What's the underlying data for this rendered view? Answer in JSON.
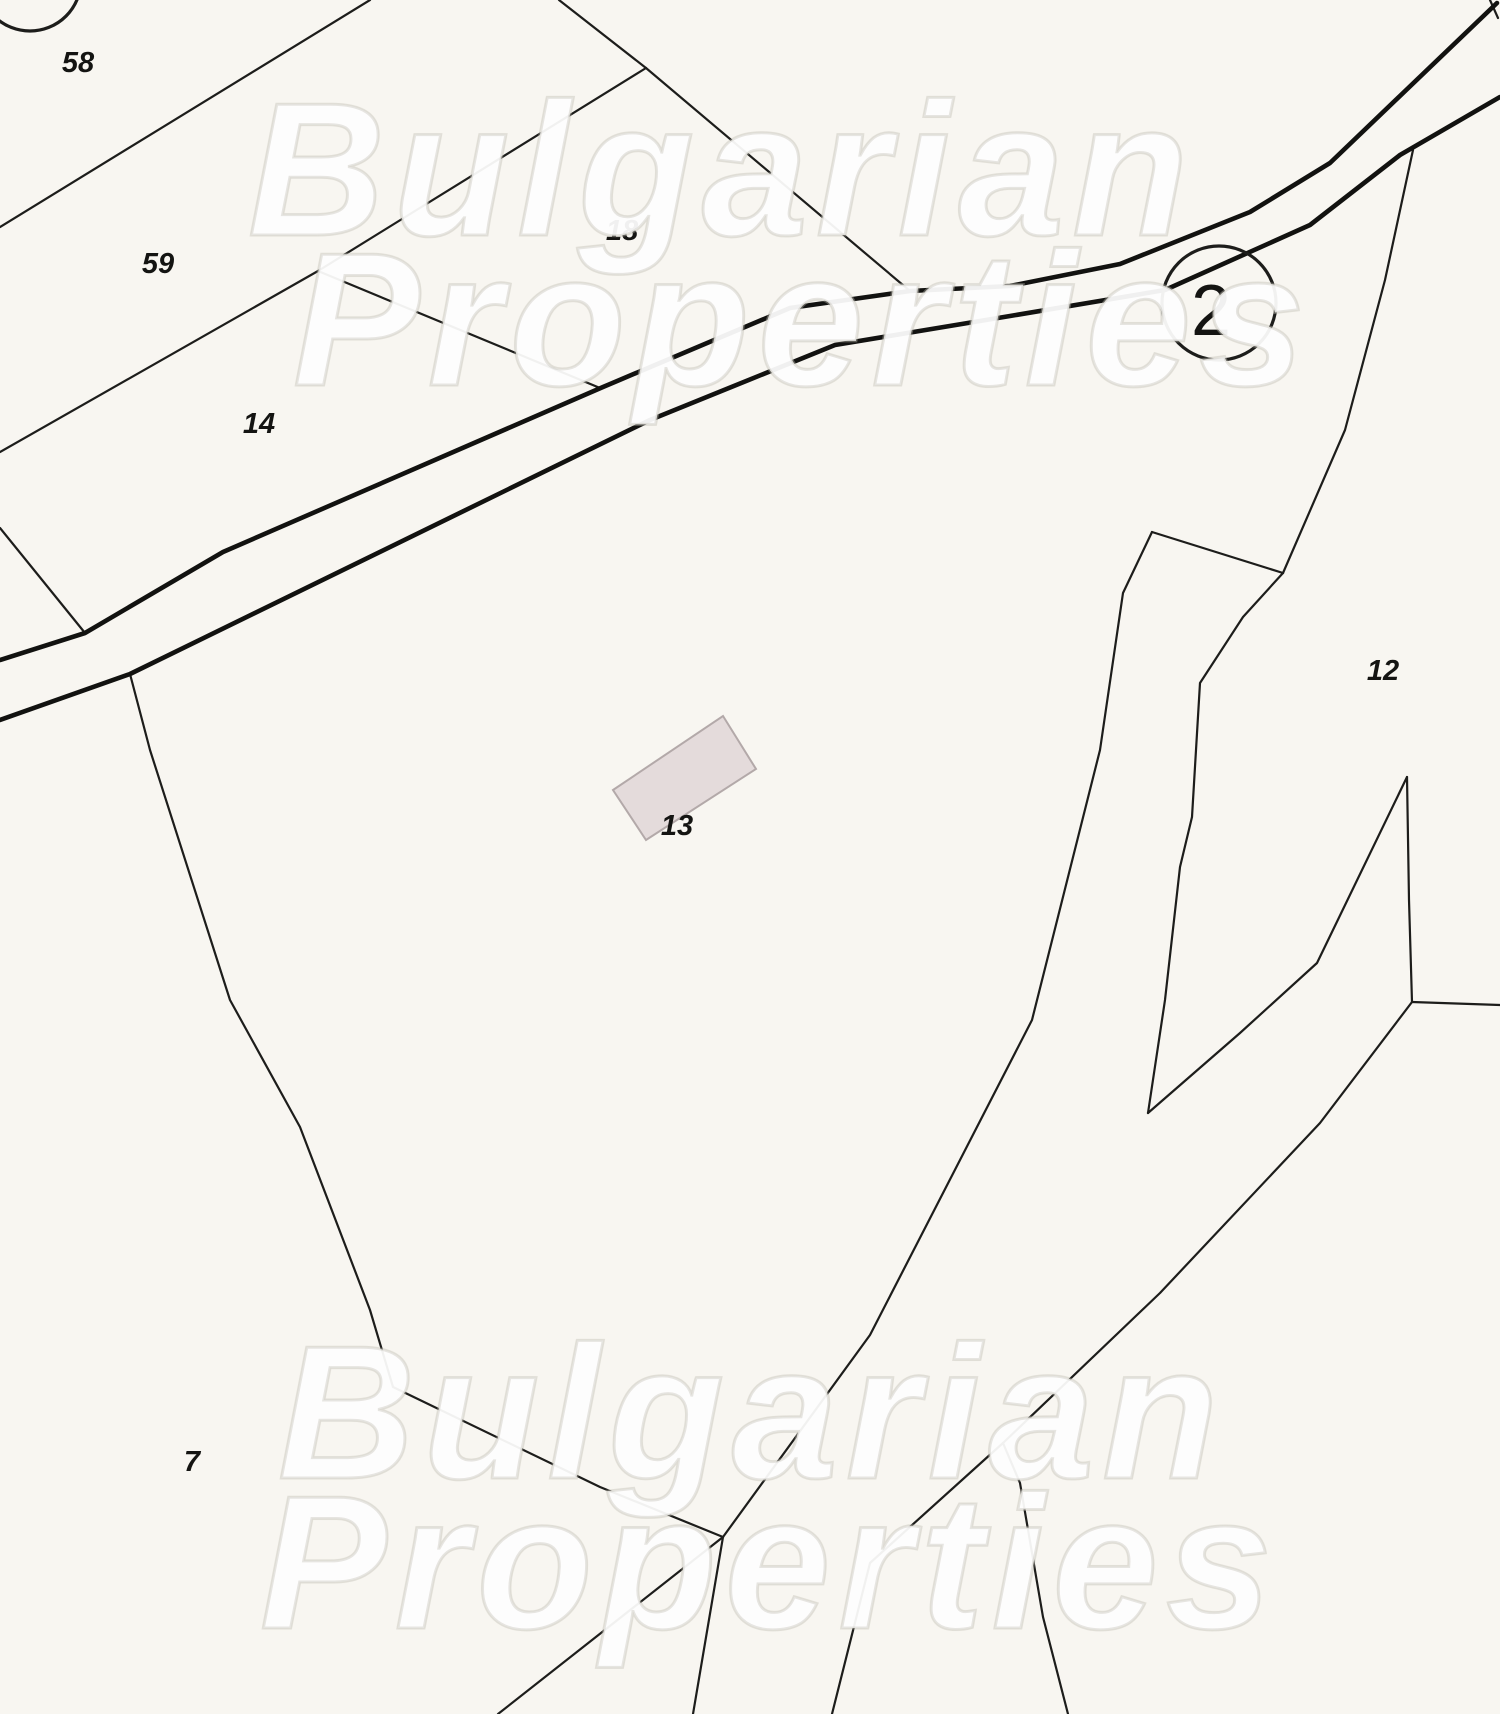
{
  "map": {
    "type": "cadastral-plan",
    "background": "#f8f6f1",
    "colors": {
      "boundary": "#1d1d1b",
      "road": "#121210",
      "label": "#141412",
      "marker": "#1d1d1b",
      "building_fill": "#e4dbdb",
      "building_stroke": "#b3a9a9"
    },
    "watermark": {
      "line1": "Bulgarian",
      "line2": "Properties"
    },
    "parcel_labels": [
      {
        "text": "58",
        "x": 78,
        "y": 63
      },
      {
        "text": "59",
        "x": 158,
        "y": 264
      },
      {
        "text": "14",
        "x": 259,
        "y": 424
      },
      {
        "text": "18",
        "x": 622,
        "y": 231
      },
      {
        "text": "13",
        "x": 677,
        "y": 826
      },
      {
        "text": "12",
        "x": 1383,
        "y": 671
      },
      {
        "text": "7",
        "x": 192,
        "y": 1462
      }
    ],
    "circle_markers": [
      {
        "label": "2",
        "cx": 1219,
        "cy": 303,
        "r": 57
      },
      {
        "label": "",
        "cx": 30,
        "cy": -20,
        "r": 51
      }
    ],
    "building": {
      "parcel": "13",
      "points": "613,790 723,716 756,769 646,840"
    },
    "roads": [
      {
        "side": "upper",
        "points": "0,660 85,633 223,552 603,387 790,308 910,291 1010,286 1120,264 1250,212 1330,163 1497,3"
      },
      {
        "side": "lower",
        "points": "0,720 130,674 650,420 835,345 1010,316 1165,290 1310,225 1400,155 1500,97"
      }
    ],
    "boundaries": [
      {
        "points": "370,0 0,227"
      },
      {
        "points": "559,0 646,68"
      },
      {
        "points": "646,68 318,271 0,452"
      },
      {
        "points": "318,271 600,388"
      },
      {
        "points": "646,68 910,291"
      },
      {
        "points": "0,528 85,633"
      },
      {
        "points": "130,674 150,750 230,1000 300,1127 370,1310 393,1387 600,1487 723,1537"
      },
      {
        "points": "723,1537 870,1335 1032,1020 1100,750 1123,593 1152,532"
      },
      {
        "points": "1152,532 1283,573"
      },
      {
        "points": "1413,150 1385,280 1345,430 1283,573"
      },
      {
        "points": "1283,573 1243,617 1200,683 1192,817 1180,867 1165,1000 1148,1113"
      },
      {
        "points": "1148,1113 1240,1033 1317,963 1407,777"
      },
      {
        "points": "1407,777 1409,900 1412,1002"
      },
      {
        "points": "1412,1002 1500,1005"
      },
      {
        "points": "1412,1002 1320,1123 1160,1293 1003,1443"
      },
      {
        "points": "1003,1443 870,1563 832,1714"
      },
      {
        "points": "1003,1443 1020,1483 1043,1617 1068,1714"
      },
      {
        "points": "723,1537 498,1714"
      },
      {
        "points": "723,1537 693,1714"
      },
      {
        "points": "1490,0 1498,18"
      }
    ]
  }
}
